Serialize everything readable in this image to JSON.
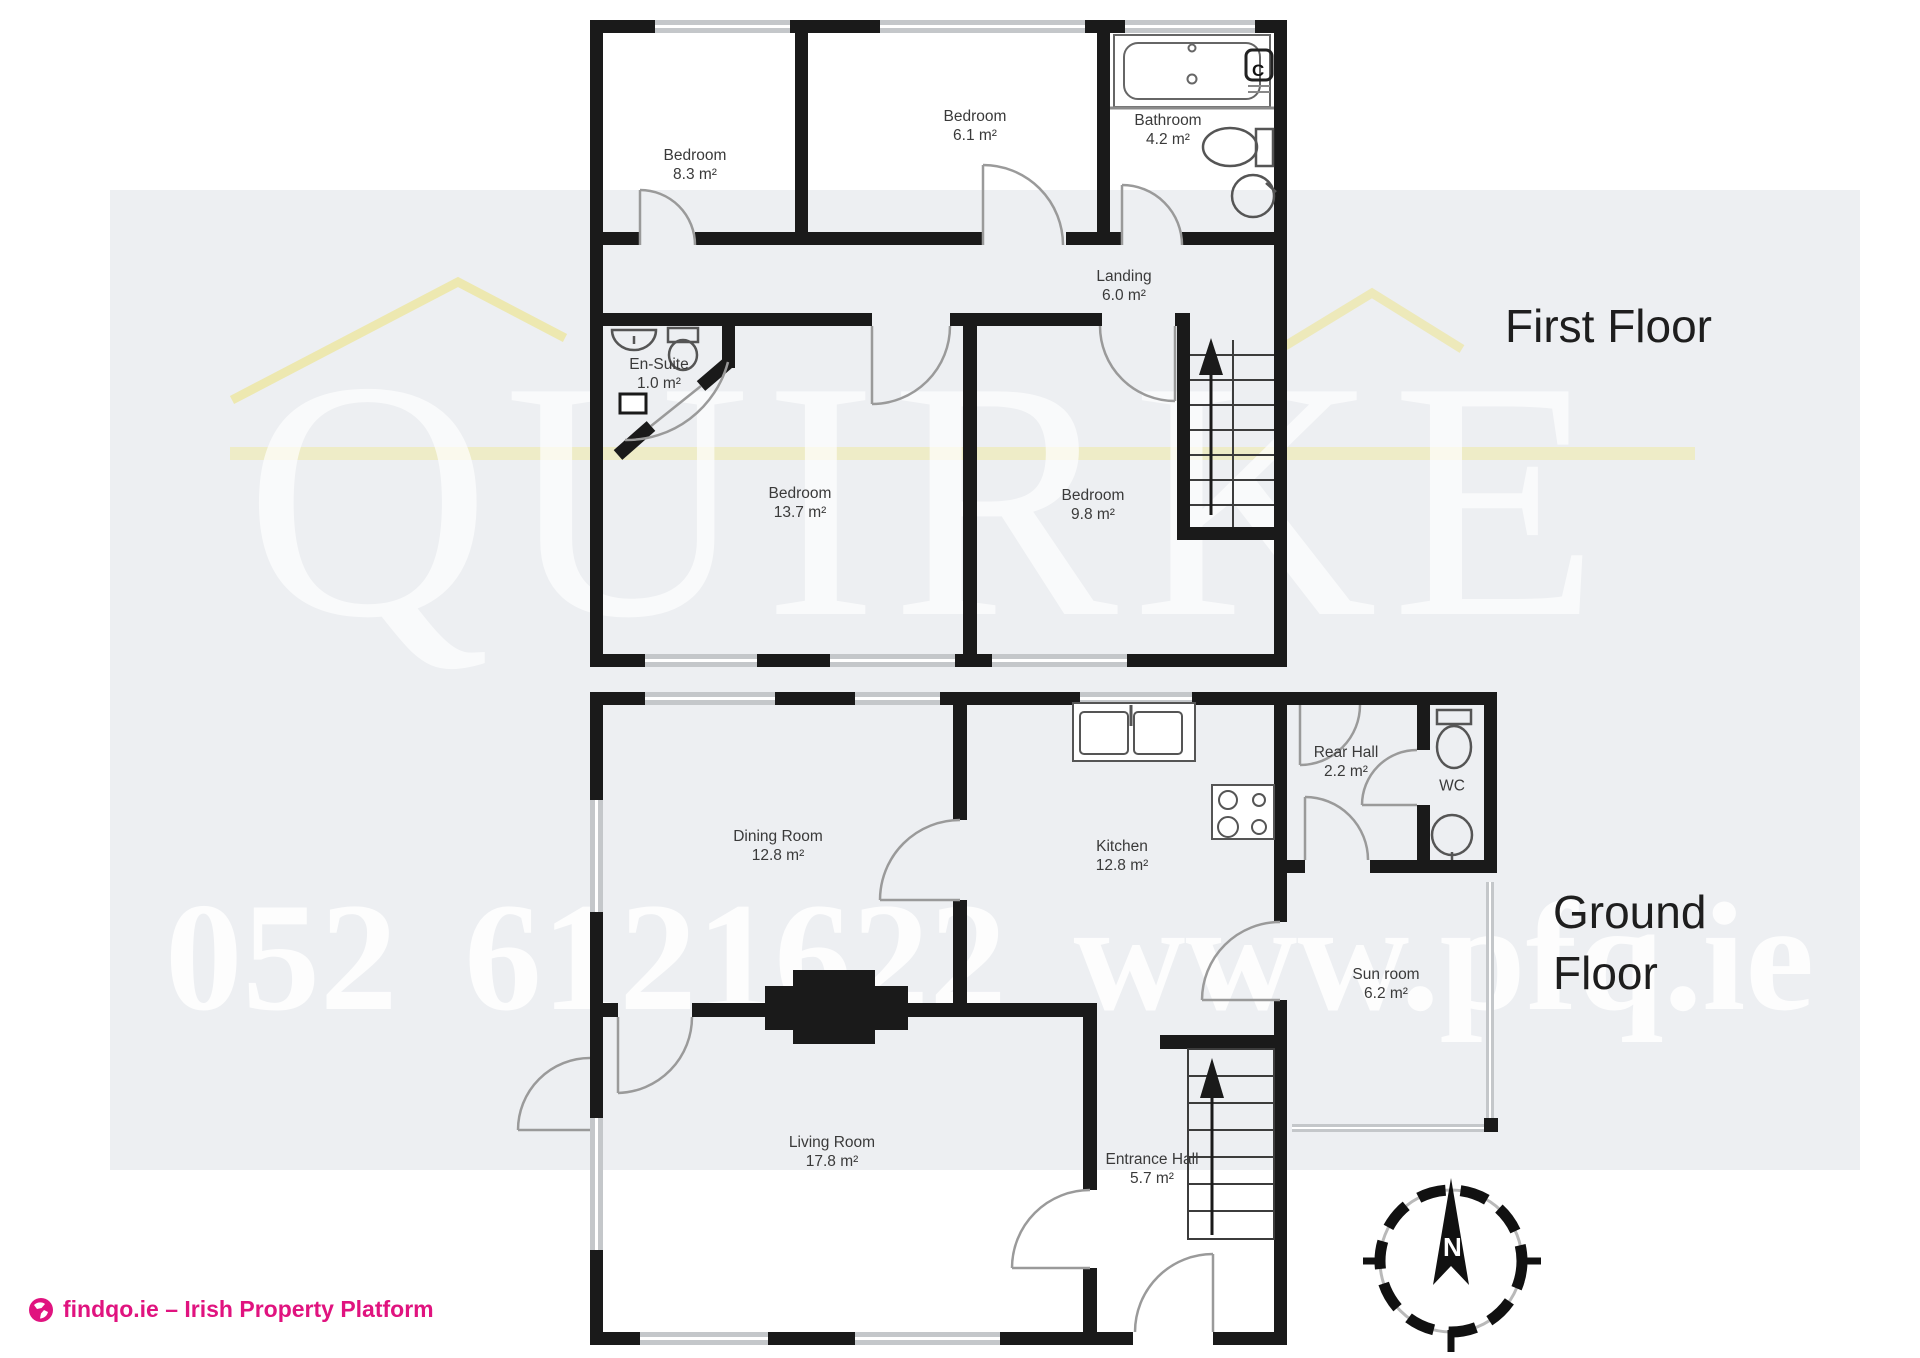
{
  "page": {
    "panel_color": "#edeff2"
  },
  "watermark": {
    "name": "QUIRKE",
    "contact": "052 6121622  www.pfq.ie"
  },
  "footer": {
    "brand": "findqo.ie – Irish Property Platform",
    "brand_color": "#e0137f"
  },
  "floors": {
    "first": {
      "title": "First Floor",
      "cylinder_label": "C",
      "rooms": {
        "bedroom1": {
          "name": "Bedroom",
          "area": "8.3 m²"
        },
        "bedroom2": {
          "name": "Bedroom",
          "area": "6.1 m²"
        },
        "bathroom": {
          "name": "Bathroom",
          "area": "4.2 m²"
        },
        "landing": {
          "name": "Landing",
          "area": "6.0 m²"
        },
        "ensuite": {
          "name": "En-Suite",
          "area": "1.0 m²"
        },
        "bedroom3": {
          "name": "Bedroom",
          "area": "13.7 m²"
        },
        "bedroom4": {
          "name": "Bedroom",
          "area": "9.8 m²"
        }
      }
    },
    "ground": {
      "title": "Ground Floor",
      "rooms": {
        "dining": {
          "name": "Dining Room",
          "area": "12.8 m²"
        },
        "kitchen": {
          "name": "Kitchen",
          "area": "12.8 m²"
        },
        "rear_hall": {
          "name": "Rear Hall",
          "area": "2.2 m²"
        },
        "wc": {
          "name": "WC"
        },
        "sunroom": {
          "name": "Sun room",
          "area": "6.2 m²"
        },
        "living": {
          "name": "Living Room",
          "area": "17.8 m²"
        },
        "entrance": {
          "name": "Entrance Hall",
          "area": "5.7 m²"
        }
      }
    }
  },
  "compass": {
    "north": "N"
  }
}
